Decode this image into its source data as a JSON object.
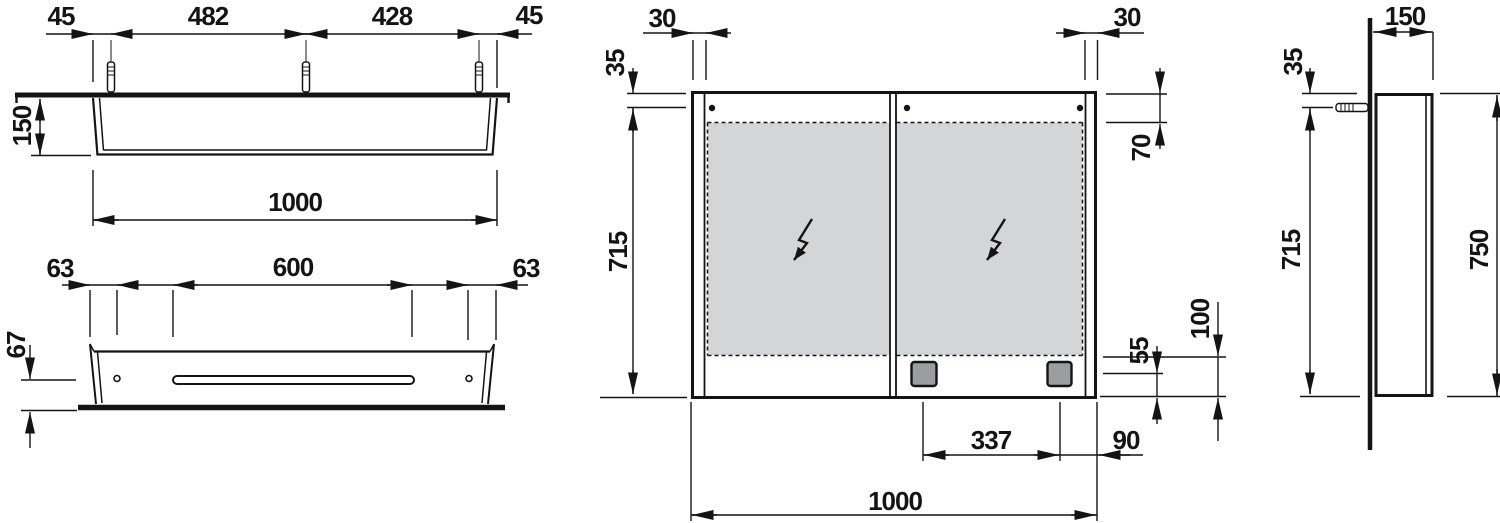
{
  "drawing": {
    "title": "mirror cabinet dimension drawing",
    "views": [
      "top-view",
      "bottom-view",
      "front-view",
      "side-view"
    ]
  },
  "colors": {
    "line": "#141414",
    "mirror_fill": "#d3d5d6",
    "socket_fill": "#9b9da0",
    "background": "#ffffff"
  },
  "dims": {
    "top": {
      "left_offset": "45",
      "anchor_span_left": "482",
      "anchor_span_right": "428",
      "right_offset": "45",
      "depth": "150",
      "width": "1000"
    },
    "bottom": {
      "left_hole": "63",
      "slot_length": "600",
      "right_hole": "63",
      "height": "67"
    },
    "front": {
      "frame_left": "30",
      "frame_right": "30",
      "top_to_hanger": "35",
      "hanger_to_bottom": "715",
      "top_to_mirror": "70",
      "socket_to_bottom": "55",
      "mirror_to_bottom": "100",
      "socket_span": "337",
      "socket_to_edge": "90",
      "width": "1000"
    },
    "side": {
      "depth": "150",
      "top_to_anchor": "35",
      "anchor_to_bottom": "715",
      "height": "750"
    }
  }
}
